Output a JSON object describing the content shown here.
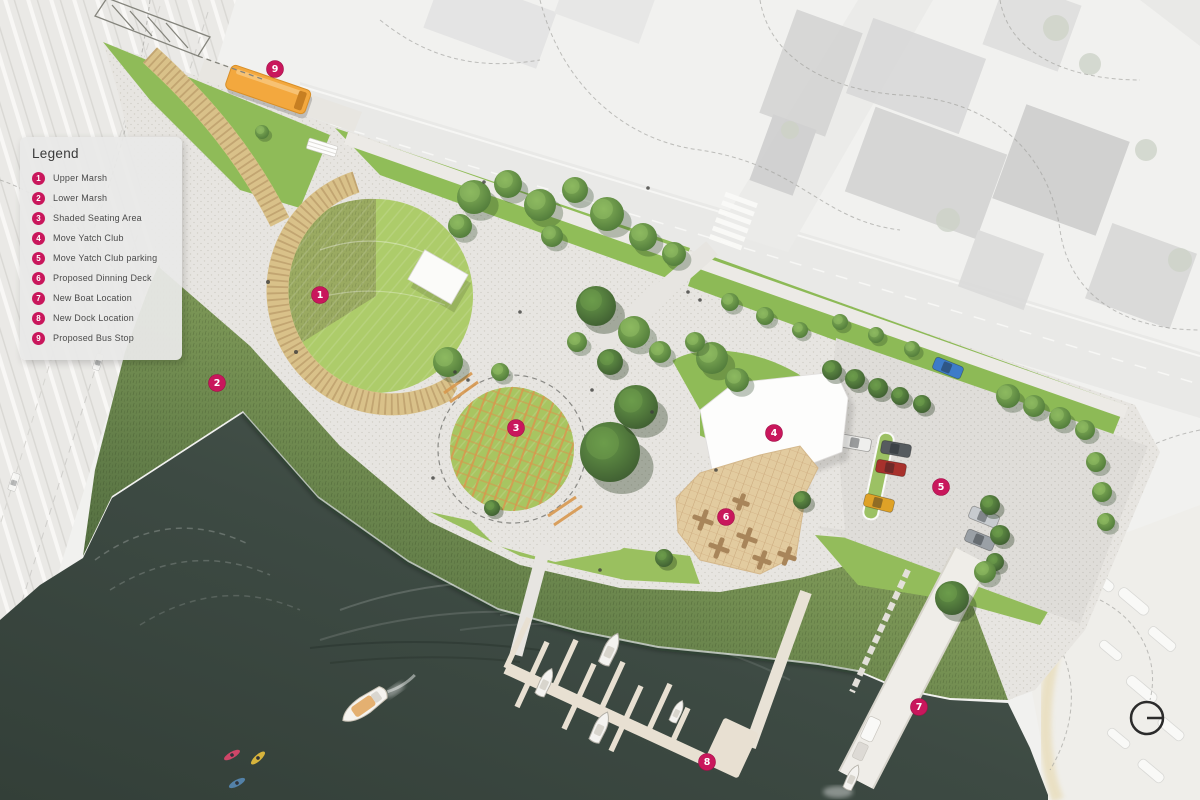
{
  "legend": {
    "title": "Legend",
    "items": [
      {
        "num": "1",
        "label": "Upper Marsh"
      },
      {
        "num": "2",
        "label": "Lower Marsh"
      },
      {
        "num": "3",
        "label": "Shaded Seating Area"
      },
      {
        "num": "4",
        "label": "Move Yatch Club"
      },
      {
        "num": "5",
        "label": "Move Yatch Club parking"
      },
      {
        "num": "6",
        "label": "Proposed Dinning Deck"
      },
      {
        "num": "7",
        "label": "New Boat Location"
      },
      {
        "num": "8",
        "label": "New Dock Location"
      },
      {
        "num": "9",
        "label": "Proposed Bus Stop"
      }
    ]
  },
  "markers": [
    {
      "num": "1",
      "x": 320,
      "y": 295
    },
    {
      "num": "2",
      "x": 217,
      "y": 383
    },
    {
      "num": "3",
      "x": 516,
      "y": 428
    },
    {
      "num": "4",
      "x": 774,
      "y": 433
    },
    {
      "num": "5",
      "x": 941,
      "y": 487
    },
    {
      "num": "6",
      "x": 726,
      "y": 517
    },
    {
      "num": "7",
      "x": 919,
      "y": 707
    },
    {
      "num": "8",
      "x": 707,
      "y": 762
    },
    {
      "num": "9",
      "x": 275,
      "y": 69
    }
  ],
  "compass": {
    "description": "circle with east-pointing line"
  },
  "colors": {
    "marker": "#c9175c",
    "water": "#3d4a43",
    "lawn": "#accb69",
    "marsh_dark": "#4a633c",
    "boardwalk": "#d9c189",
    "deck": "#e2cb9f",
    "bus": "#f3a83e",
    "path": "#e7e5e1"
  }
}
